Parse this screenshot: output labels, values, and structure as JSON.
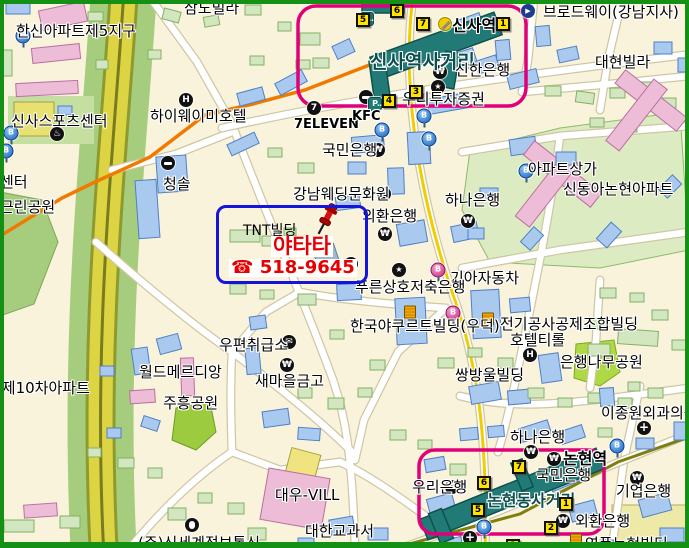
{
  "colors": {
    "land": "#FAF3DC",
    "road_fill": "#FFFFFF",
    "road_casing": "#CFC7A4",
    "yellow_road": "#DCD443",
    "green_strip": "#A6CC7E",
    "station_teal": "#227A76",
    "line3_orange": "#F07A00",
    "line7_olive": "#7F7F10",
    "highlight_pink": "#E0007A",
    "highlight_blue": "#1414DC",
    "ad_red": "#E60000",
    "exit_yellow": "#FFE400",
    "frame_green": "#149114"
  },
  "ad": {
    "building": "TNT빌딩",
    "name": "야타타",
    "phone": "☎ 518-9645"
  },
  "labels": [
    {
      "id": "samdo-villa",
      "t": "삼도빌라",
      "x": 184,
      "y": 1
    },
    {
      "id": "hanshin-apt-5",
      "t": "한신아파트제5지구",
      "x": 16,
      "y": 24
    },
    {
      "id": "sinsa-sports-center",
      "t": "신사스포츠센터",
      "x": 11,
      "y": 114
    },
    {
      "id": "highway-hotel",
      "t": "하이웨이미호텔",
      "x": 150,
      "y": 109
    },
    {
      "id": "sinsa-intersection",
      "t": "신사역사거리",
      "x": 370,
      "y": 53,
      "c": "xl"
    },
    {
      "id": "sinsa-station",
      "t": "신사역",
      "x": 452,
      "y": 18,
      "c": "st"
    },
    {
      "id": "broadway-gangnam",
      "t": "브로드웨이(강남지사)",
      "x": 543,
      "y": 5
    },
    {
      "id": "daehyeon-villa",
      "t": "대현빌라",
      "x": 595,
      "y": 55
    },
    {
      "id": "shinhan-bank",
      "t": "신한은행",
      "x": 455,
      "y": 63
    },
    {
      "id": "woori-securities",
      "t": "우리투자증권",
      "x": 402,
      "y": 92
    },
    {
      "id": "seven-eleven",
      "t": "7ELEVEN",
      "x": 294,
      "y": 118,
      "c": "latin"
    },
    {
      "id": "kfc",
      "t": "KFC",
      "x": 352,
      "y": 110,
      "c": "latin"
    },
    {
      "id": "kookmin-bank-north",
      "t": "국민은행",
      "x": 322,
      "y": 143
    },
    {
      "id": "cheongsol",
      "t": "청솔",
      "x": 163,
      "y": 177
    },
    {
      "id": "gangnam-wedding",
      "t": "강남웨딩문화원",
      "x": 293,
      "y": 187
    },
    {
      "id": "keb-center",
      "t": "외환은행",
      "x": 362,
      "y": 209
    },
    {
      "id": "hana-bank-mid",
      "t": "하나은행",
      "x": 445,
      "y": 193
    },
    {
      "id": "apt-shops",
      "t": "아파트상가",
      "x": 528,
      "y": 162
    },
    {
      "id": "sindonga-apt",
      "t": "신동아논현아파트",
      "x": 563,
      "y": 182
    },
    {
      "id": "kia-motors",
      "t": "기아자동차",
      "x": 450,
      "y": 271
    },
    {
      "id": "pureun-savings-bank",
      "t": "푸른상호저축은행",
      "x": 355,
      "y": 280
    },
    {
      "id": "yakult-bldg",
      "t": "한국야쿠르트빌딩(우덕)",
      "x": 350,
      "y": 319
    },
    {
      "id": "elec-assoc-bldg",
      "t": "전기공사공제조합빌딩",
      "x": 500,
      "y": 317
    },
    {
      "id": "hotel-tirol",
      "t": "호텔티롤",
      "x": 510,
      "y": 333
    },
    {
      "id": "ginkgo-park",
      "t": "은행나무공원",
      "x": 560,
      "y": 355
    },
    {
      "id": "ssangbangwool-bldg",
      "t": "쌍방울빌딩",
      "x": 455,
      "y": 368
    },
    {
      "id": "postal-agency",
      "t": "우편취급소",
      "x": 219,
      "y": 338
    },
    {
      "id": "saemaul-geumgo",
      "t": "새마을금고",
      "x": 255,
      "y": 374
    },
    {
      "id": "world-meridian",
      "t": "월드메르디앙",
      "x": 139,
      "y": 365
    },
    {
      "id": "juheung-park",
      "t": "주흥공원",
      "x": 163,
      "y": 396
    },
    {
      "id": "apt-10th",
      "t": "트제10차아파트",
      "x": -12,
      "y": 381
    },
    {
      "id": "center-partial",
      "t": "센터",
      "x": 0,
      "y": 175
    },
    {
      "id": "neighborhood-park",
      "t": "근린공원",
      "x": 0,
      "y": 200
    },
    {
      "id": "daewoo-vill",
      "t": "대우-VILL",
      "x": 275,
      "y": 488
    },
    {
      "id": "daehan-textbook",
      "t": "대한교과서",
      "x": 305,
      "y": 524
    },
    {
      "id": "shinsegae-it",
      "t": "(주)신세계정보통신",
      "x": 138,
      "y": 536
    },
    {
      "id": "woori-bank-south",
      "t": "우리은행",
      "x": 412,
      "y": 480
    },
    {
      "id": "nonhyeon-intersection",
      "t": "논현동사거리",
      "x": 487,
      "y": 493,
      "c": "big"
    },
    {
      "id": "hana-bank-south",
      "t": "하나은행",
      "x": 510,
      "y": 430
    },
    {
      "id": "nonhyeon-station",
      "t": "논현역",
      "x": 563,
      "y": 451,
      "c": "st"
    },
    {
      "id": "kookmin-bank-south",
      "t": "국민은행",
      "x": 536,
      "y": 468
    },
    {
      "id": "ibk-bank",
      "t": "기업은행",
      "x": 616,
      "y": 484
    },
    {
      "id": "keb-south",
      "t": "외환은행",
      "x": 575,
      "y": 514
    },
    {
      "id": "clinic",
      "t": "이종원외과의원",
      "x": 601,
      "y": 406
    },
    {
      "id": "yeongpoong-bldg",
      "t": "영풍논현빌딩",
      "x": 585,
      "y": 537
    }
  ],
  "icons": [
    {
      "n": "won",
      "x": 378,
      "y": 150
    },
    {
      "n": "won",
      "x": 440,
      "y": 72
    },
    {
      "n": "won",
      "x": 385,
      "y": 234
    },
    {
      "n": "won",
      "x": 468,
      "y": 221
    },
    {
      "n": "won",
      "x": 287,
      "y": 365
    },
    {
      "n": "won",
      "x": 452,
      "y": 487
    },
    {
      "n": "won",
      "x": 563,
      "y": 521
    },
    {
      "n": "won",
      "x": 637,
      "y": 478
    },
    {
      "n": "won",
      "x": 531,
      "y": 452
    },
    {
      "n": "won",
      "x": 554,
      "y": 459
    },
    {
      "n": "star",
      "x": 438,
      "y": 87
    },
    {
      "n": "star",
      "x": 351,
      "y": 264
    },
    {
      "n": "star",
      "x": 399,
      "y": 270
    },
    {
      "n": "heart",
      "x": 384,
      "y": 194
    },
    {
      "n": "hotel",
      "x": 186,
      "y": 100
    },
    {
      "n": "hotel",
      "x": 530,
      "y": 355
    },
    {
      "n": "cross",
      "x": 644,
      "y": 428
    },
    {
      "n": "cross",
      "x": 470,
      "y": 538
    },
    {
      "n": "envelope",
      "x": 289,
      "y": 342
    },
    {
      "n": "seven",
      "x": 314,
      "y": 108
    },
    {
      "n": "subway",
      "x": 366,
      "y": 97
    },
    {
      "n": "subway",
      "x": 168,
      "y": 163
    },
    {
      "n": "bike",
      "x": 367,
      "y": 19
    },
    {
      "n": "bike",
      "x": 375,
      "y": 104
    },
    {
      "n": "mouse",
      "x": 192,
      "y": 525
    },
    {
      "n": "building",
      "x": 410,
      "y": 312
    },
    {
      "n": "building",
      "x": 488,
      "y": 319
    },
    {
      "n": "building",
      "x": 576,
      "y": 540
    },
    {
      "n": "theater",
      "x": 528,
      "y": 11
    },
    {
      "n": "line3",
      "x": 445,
      "y": 24
    },
    {
      "n": "spa",
      "x": 57,
      "y": 134
    },
    {
      "n": "bus-blue",
      "x": 23,
      "y": 36
    },
    {
      "n": "bus-blue",
      "x": 11,
      "y": 133
    },
    {
      "n": "bus-blue",
      "x": 6,
      "y": 151
    },
    {
      "n": "bus-blue",
      "x": 424,
      "y": 116
    },
    {
      "n": "bus-blue",
      "x": 382,
      "y": 130
    },
    {
      "n": "bus-blue",
      "x": 429,
      "y": 139
    },
    {
      "n": "bus-blue",
      "x": 526,
      "y": 171
    },
    {
      "n": "bus-blue",
      "x": 484,
      "y": 527
    },
    {
      "n": "bus-blue",
      "x": 617,
      "y": 446
    },
    {
      "n": "bus-pink",
      "x": 438,
      "y": 270
    },
    {
      "n": "bus-pink",
      "x": 453,
      "y": 313
    },
    {
      "n": "pushpin",
      "x": 327,
      "y": 220
    }
  ],
  "exits": [
    {
      "n": "5",
      "x": 356,
      "y": 13
    },
    {
      "n": "6",
      "x": 390,
      "y": 4
    },
    {
      "n": "7",
      "x": 416,
      "y": 17
    },
    {
      "n": "1",
      "x": 496,
      "y": 17
    },
    {
      "n": "3",
      "x": 409,
      "y": 85
    },
    {
      "n": "4",
      "x": 382,
      "y": 94
    },
    {
      "n": "6",
      "x": 477,
      "y": 476
    },
    {
      "n": "5",
      "x": 471,
      "y": 503
    },
    {
      "n": "7",
      "x": 512,
      "y": 460
    },
    {
      "n": "1",
      "x": 559,
      "y": 497
    },
    {
      "n": "2",
      "x": 544,
      "y": 521
    },
    {
      "n": "3",
      "x": 506,
      "y": 539
    }
  ]
}
